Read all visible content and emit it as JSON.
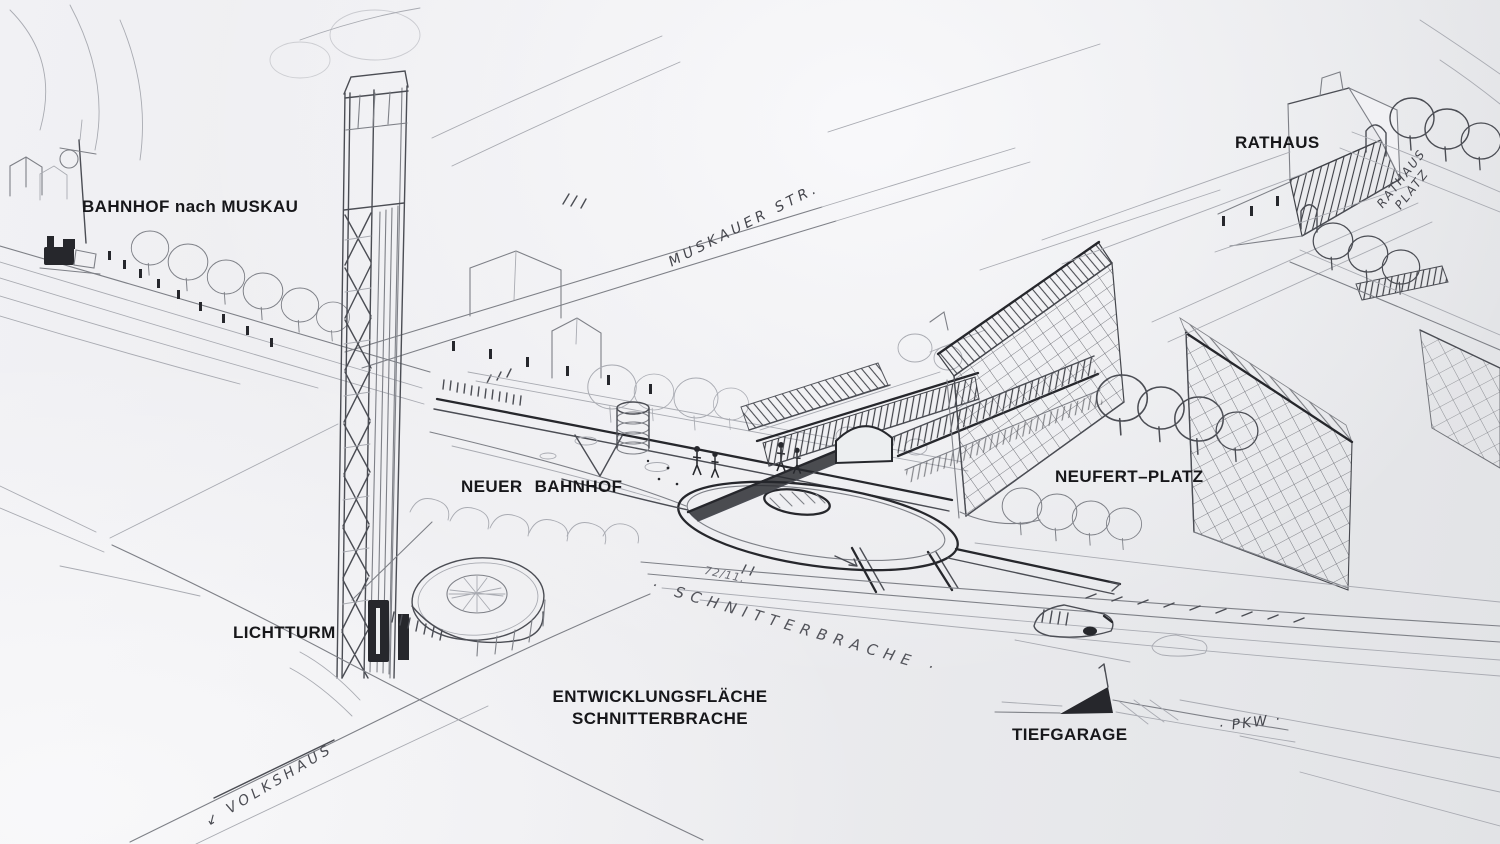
{
  "sketch": {
    "printed_labels": {
      "bahnhof_nach_muskau": "BAHNHOF nach MUSKAU",
      "rathaus": "RATHAUS",
      "neuer_bahnhof": "NEUER BAHNHOF",
      "neufert_platz": "NEUFERT–PLATZ",
      "lichtturm": "LICHTTURM",
      "entwicklungsflaeche_line1": "ENTWICKLUNGSFLÄCHE",
      "entwicklungsflaeche_line2": "SCHNITTERBRACHE",
      "tiefgarage": "TIEFGARAGE"
    },
    "handwritten_labels": {
      "muskauer_str": "MUSKAUER STR.",
      "rathaus_platz_line1": "RATHAUS",
      "rathaus_platz_line2": "PLATZ",
      "schnitterbrache": "· SCHNITTERBRACHE ·",
      "volkshaus": "↙ VOLKSHAUS",
      "pkw": "· PKW ·",
      "site_note": "72/11."
    },
    "colors": {
      "paper": "#ededf0",
      "ink_bold": "#26272c",
      "pencil_dark": "#4b4d54",
      "pencil_medium": "#7e8087",
      "pencil_light": "#a9abb2",
      "label_text": "#17171a"
    }
  }
}
